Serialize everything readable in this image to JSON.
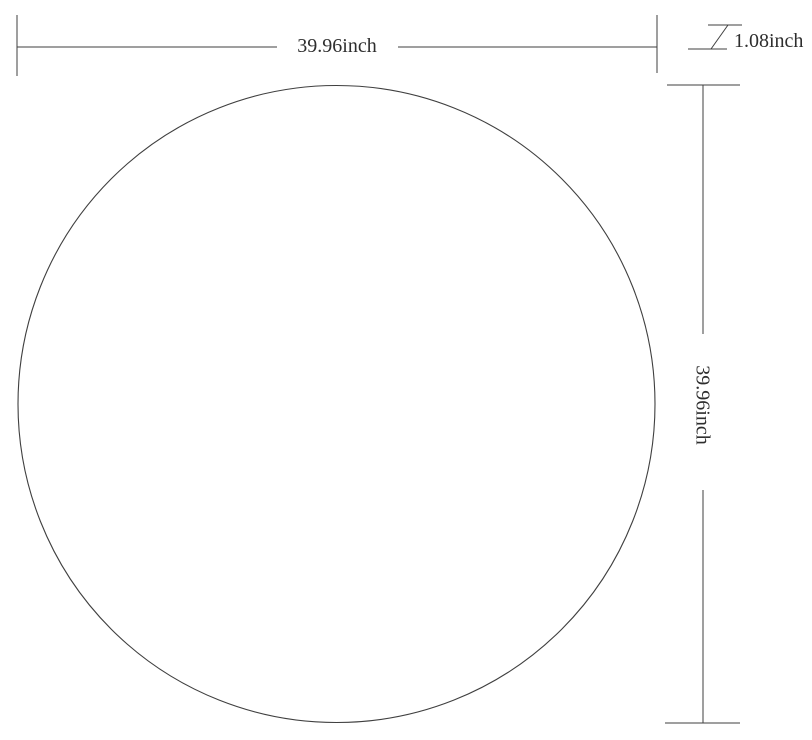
{
  "diagram": {
    "shape": "circle",
    "dimensions": {
      "width": {
        "value": 39.96,
        "unit": "inch",
        "label": "39.96inch"
      },
      "height": {
        "value": 39.96,
        "unit": "inch",
        "label": "39.96inch"
      },
      "thickness": {
        "value": 1.08,
        "unit": "inch",
        "label": "1.08inch"
      }
    }
  },
  "colors": {
    "line": "#3f3f3f",
    "text": "#2e2e2e",
    "background": "#ffffff"
  }
}
